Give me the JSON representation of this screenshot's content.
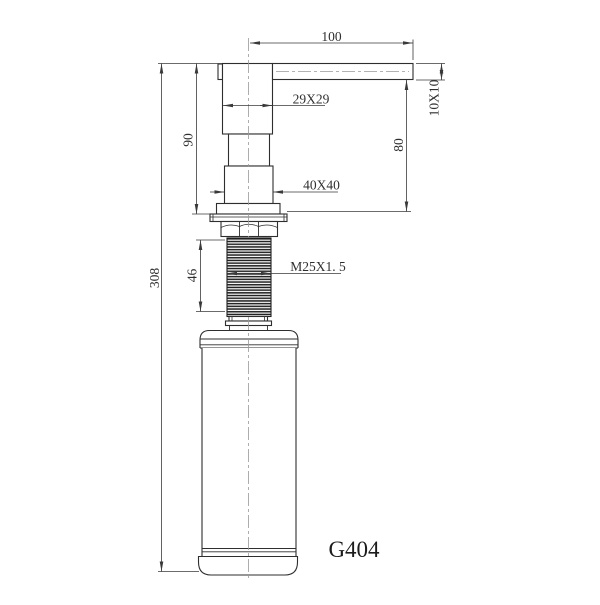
{
  "title": "G404",
  "colors": {
    "outline": "#2e2e2e",
    "dimension": "#3a3a3a",
    "centerline": "#999999",
    "thread_fill": "#1f1f1f",
    "background": "#ffffff"
  },
  "labels": {
    "spout_reach": "100",
    "body_section": "29X29",
    "spout_section": "10X10",
    "spout_to_deck": "80",
    "body_height": "90",
    "base_section": "40X40",
    "thread_spec": "M25X1. 5",
    "thread_length": "46",
    "overall_height": "308",
    "model": "G404"
  }
}
